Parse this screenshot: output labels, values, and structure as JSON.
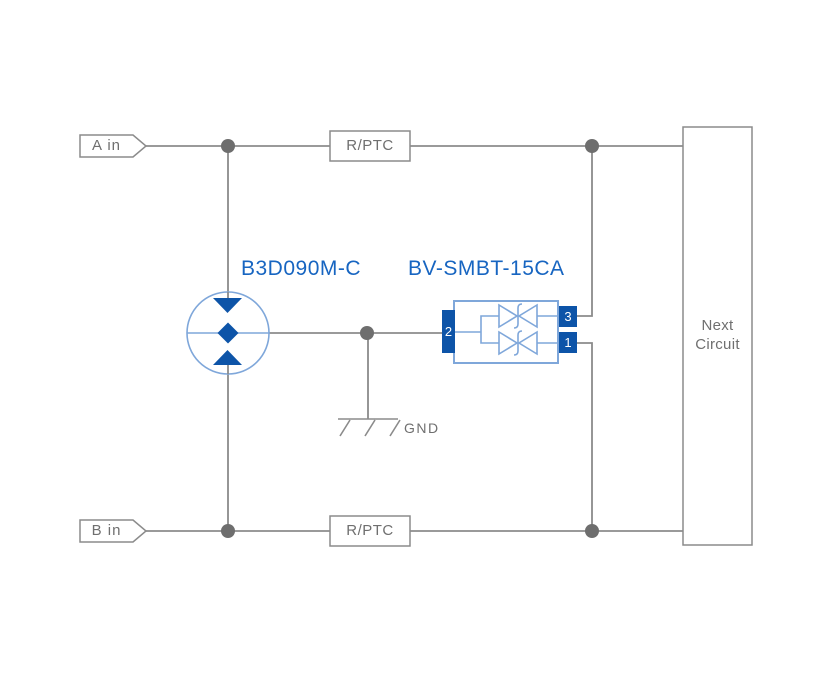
{
  "inputs": {
    "a_label": "A in",
    "b_label": "B in"
  },
  "series_protection": {
    "top_label": "R/PTC",
    "bottom_label": "R/PTC"
  },
  "gdt": {
    "part_number": "B3D090M-C"
  },
  "tvs": {
    "part_number": "BV-SMBT-15CA",
    "pin_left": "2",
    "pin_top_right": "3",
    "pin_bottom_right": "1"
  },
  "ground": {
    "label": "GND"
  },
  "next_circuit": {
    "line1": "Next",
    "line2": "Circuit"
  },
  "colors": {
    "wire_gray": "#8B8B8B",
    "junction_gray": "#6E6E6E",
    "text_gray": "#6F6F6F",
    "solid_blue": "#0D54A8",
    "light_blue": "#7FA7DA",
    "label_blue": "#1765C1",
    "background": "#FFFFFF"
  }
}
